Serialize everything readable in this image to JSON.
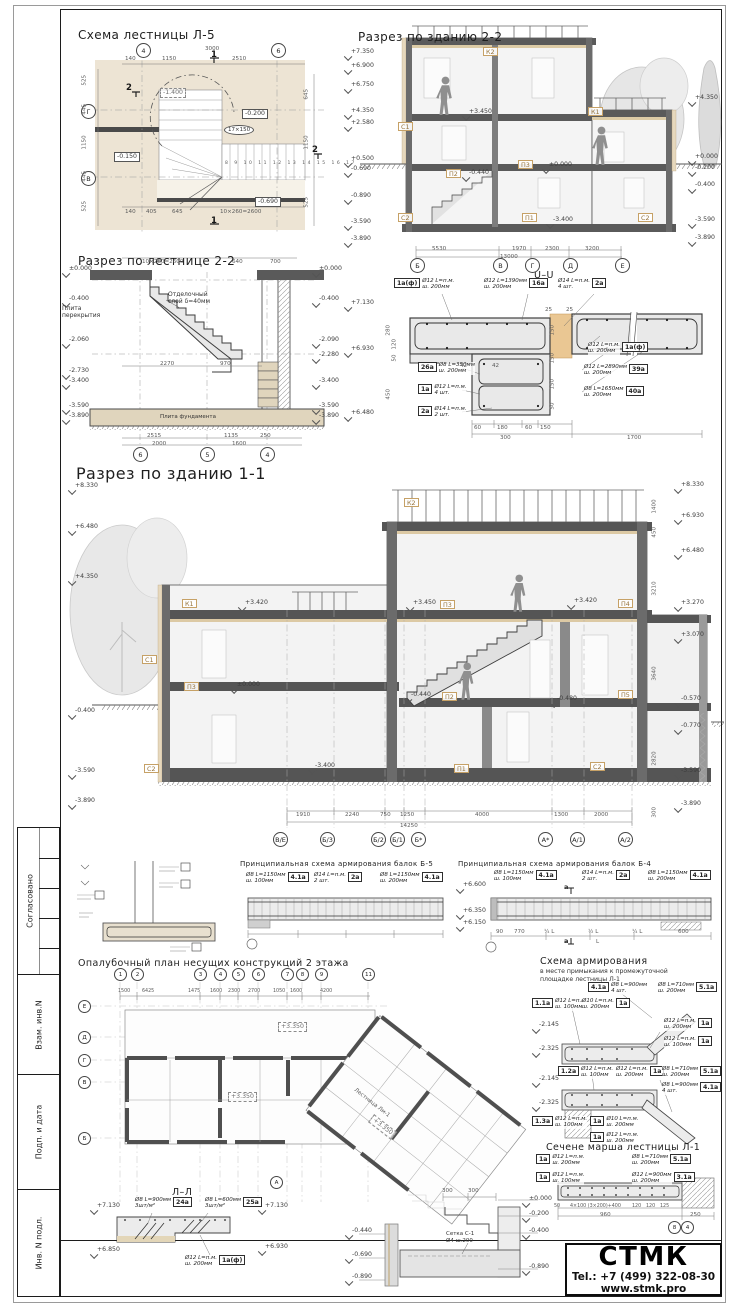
{
  "sidebar": {
    "cells": [
      "Согласовано",
      "Взам. инв.N",
      "Подп. и дата",
      "Инв. N подл."
    ]
  },
  "title_block": {
    "company": "СТМК",
    "phone": "Tel.: +7 (499) 322-08-30",
    "site": "www.stmk.pro"
  },
  "stair_plan": {
    "title": "Схема лестницы Л-5",
    "grid_top": [
      "4",
      "6"
    ],
    "grid_left": [
      "Г",
      "В"
    ],
    "dim_total_top": "3000",
    "dims_top": [
      "140",
      "1150",
      "2510"
    ],
    "dims_bottom": [
      "140",
      "405",
      "645",
      "10×260=2600"
    ],
    "dims_left": [
      "525",
      "445",
      "1150",
      "445",
      "525"
    ],
    "dims_right": [
      "645",
      "1150",
      "525"
    ],
    "elev_dashed": "-1.400",
    "elev_boxes": [
      "-0.200",
      "-0.150",
      "-0.690"
    ],
    "flight_label": "17×150",
    "tread_numbers": "8 9 10 11 12 13 14 15 16 17",
    "cut_marks": [
      "1",
      "1",
      "2",
      "2"
    ]
  },
  "section22": {
    "title": "Разрез по зданию 2-2",
    "elev_left": [
      "+7.350",
      "+6.900",
      "+6.750",
      "+4.350",
      "+2.580",
      "+0.500",
      "-0.690",
      "-0.890",
      "-3.590",
      "-3.890"
    ],
    "elev_right": [
      "+4.350",
      "+0.000",
      "-0.200",
      "-0.400",
      "-3.590",
      "-3.890"
    ],
    "marks": [
      "+3.450",
      "-0.440",
      "±0.000",
      "-3.400"
    ],
    "tags": [
      "К2",
      "К1",
      "С1",
      "П3",
      "П2",
      "С2",
      "П1",
      "С2"
    ],
    "dims_bottom": [
      "5530",
      "1970",
      "2300",
      "3200"
    ],
    "dim_total": "13000",
    "grid_bottom": [
      "Б",
      "В",
      "Г",
      "Д",
      "Е"
    ]
  },
  "stair_section": {
    "title": "Разрез по лестнице 2-2",
    "elev_left": [
      "±0.000",
      "-0.400",
      "-2.060",
      "-2.730",
      "-3.400",
      "-3.590",
      "-3.890"
    ],
    "elev_right": [
      "±0.000",
      "-0.400",
      "-2.090",
      "-2.280",
      "-3.400",
      "-3.590",
      "-3.890"
    ],
    "note_slab": "Плита перекрытия",
    "note_finish_1": "Отделочный",
    "note_finish_2": "слой δ=40мм",
    "note_found": "Плита фундамента",
    "dims_top": [
      "10×260=2600",
      "640",
      "700"
    ],
    "dims_mid": [
      "2270",
      "970"
    ],
    "dims_bottom_1": [
      "2515",
      "1135",
      "250"
    ],
    "dims_bottom_2": [
      "2000",
      "1600"
    ],
    "grid_bottom": [
      "6",
      "5",
      "4"
    ]
  },
  "uu": {
    "title": "U–U",
    "elevs": [
      "+7.130",
      "+6.930",
      "+6.480"
    ],
    "co_box_first": [
      {
        "tag": "1а(ф)",
        "l1": "Ø12 L=п.м.",
        "l2": "ш. 200мм"
      },
      {
        "tag": "26а",
        "l1": "Ø8 L=350мм",
        "l2": "ш. 200мм"
      },
      {
        "tag": "1а",
        "l1": "Ø12 L=п.м.",
        "l2": "4 шт."
      },
      {
        "tag": "2а",
        "l1": "Ø14 L=п.м.",
        "l2": "2 шт."
      }
    ],
    "co_text_first": [
      {
        "tag": "16а",
        "l1": "Ø12 L=1390мм",
        "l2": "ш. 200мм"
      },
      {
        "tag": "2а",
        "l1": "Ø14 L=п.м.",
        "l2": "4 шт."
      },
      {
        "tag": "1а(ф)",
        "l1": "Ø12 L=п.м.",
        "l2": "ш. 200мм"
      },
      {
        "tag": "39а",
        "l1": "Ø12 L=2890мм",
        "l2": "ш. 200мм"
      },
      {
        "tag": "40а",
        "l1": "Ø8 L=1650мм",
        "l2": "ш. 200мм"
      }
    ],
    "dims_h": [
      "60",
      "180",
      "60",
      "150"
    ],
    "dims_row2": [
      "300",
      "1700"
    ],
    "dims_v_left": [
      "280",
      "120",
      "50",
      "450"
    ],
    "dims_v_right": [
      "150",
      "150",
      "150",
      "50"
    ],
    "dims_small": [
      "25",
      "25",
      "42",
      "42"
    ]
  },
  "section11": {
    "title": "Разрез по зданию 1-1",
    "elev_left": [
      "+8.330",
      "+6.480",
      "+4.350",
      "-0.400",
      "-3.590",
      "-3.890"
    ],
    "elev_right": [
      "+8.330",
      "+6.930",
      "+6.480",
      "+3.270",
      "+3.070",
      "-0.570",
      "-0.770",
      "-3.590",
      "-3.890"
    ],
    "marks": [
      "+3.420",
      "+3.450",
      "+3.420",
      "±0.000",
      "-0.440",
      "-0.480",
      "-3.400"
    ],
    "tags": [
      "К2",
      "К1",
      "П3",
      "П4",
      "С1",
      "П3",
      "П2",
      "П5",
      "С2",
      "П1",
      "С2"
    ],
    "dims_bottom": [
      "1910",
      "2240",
      "750",
      "1250",
      "4000",
      "1300",
      "2000"
    ],
    "dim_total": "14250",
    "grid_bottom": [
      "В/Е",
      "Б/3",
      "Б/2",
      "Б/1",
      "Б*",
      "А*",
      "А/1",
      "А/2"
    ],
    "dims_v_right": [
      "1400",
      "450",
      "3210",
      "3640",
      "2820",
      "300"
    ]
  },
  "beam_b5": {
    "title": "Принципиальная схема армирования балок Б-5",
    "callouts": [
      {
        "tag": "4.1а",
        "l1": "Ø8 L=1150мм",
        "l2": "ш. 100мм"
      },
      {
        "tag": "2а",
        "l1": "Ø14 L=п.м.",
        "l2": "2 шт."
      },
      {
        "tag": "4.1а",
        "l1": "Ø8 L=1150мм",
        "l2": "ш. 200мм"
      }
    ]
  },
  "beam_b4": {
    "title": "Принципиальная схема армирования балок Б-4",
    "elevs": [
      "+6.600",
      "+6.350",
      "+6.150"
    ],
    "callouts": [
      {
        "tag": "4.1а",
        "l1": "Ø8 L=1150мм",
        "l2": "ш. 100мм"
      },
      {
        "tag": "2а",
        "l1": "Ø14 L=п.м.",
        "l2": "2 шт."
      },
      {
        "tag": "4.1а",
        "l1": "Ø8 L=1150мм",
        "l2": "ш. 200мм"
      }
    ],
    "dims": [
      "90",
      "770",
      "¼ L",
      "½ L",
      "¼ L",
      "600"
    ],
    "dim_total": "L",
    "cut_label": "а"
  },
  "plan2": {
    "title": "Опалубочный план несущих конструкций 2 этажа",
    "grid_top": [
      "1",
      "2",
      "3",
      "4",
      "5",
      "6",
      "7",
      "8",
      "9",
      "11"
    ],
    "grid_left": [
      "Е",
      "Д",
      "Г",
      "В",
      "Б"
    ],
    "grid_extra": "А",
    "dims_top": [
      "1500",
      "6425",
      "1475",
      "1600",
      "2300",
      "2700",
      "1050",
      "1600",
      "4200"
    ],
    "elev_boxes": [
      "+3.350",
      "+3.350",
      "+3.350"
    ],
    "stair_label": "Лестница Лм-1"
  },
  "reinf": {
    "title": "Схема армирования",
    "subtitle1": "в месте примыкания к промежуточной",
    "subtitle2": "площадке лестницы Л-1",
    "a_elevs": [
      "-2.145",
      "-2.325"
    ],
    "b_elevs": [
      "-2.145",
      "-2.325"
    ],
    "a_box_first": [
      {
        "tag": "1.1а",
        "l1": "Ø12 L=п.м.",
        "l2": "ш. 100мм"
      },
      {
        "tag": "4.1а",
        "l1": "Ø8 L=900мм",
        "l2": "4 шт."
      }
    ],
    "a_text_first": [
      {
        "tag": "1а",
        "l1": "Ø10 L=п.м.",
        "l2": "ш. 200мм"
      },
      {
        "tag": "5.1а",
        "l1": "Ø8 L=710мм",
        "l2": "ш. 200мм"
      },
      {
        "tag": "1а",
        "l1": "Ø12 L=п.м.",
        "l2": "ш. 200мм"
      },
      {
        "tag": "1а",
        "l1": "Ø12 L=п.м.",
        "l2": "ш. 100мм"
      }
    ],
    "b_box_first": [
      {
        "tag": "1.2а",
        "l1": "Ø12 L=п.м.",
        "l2": "ш. 100мм"
      },
      {
        "tag": "1.3а",
        "l1": "Ø12 L=п.м.",
        "l2": "ш. 100мм"
      },
      {
        "tag": "1а",
        "l1": "Ø10 L=п.м.",
        "l2": "ш. 200мм"
      },
      {
        "tag": "1а",
        "l1": "Ø12 L=п.м.",
        "l2": "ш. 200мм"
      }
    ],
    "b_text_first": [
      {
        "tag": "1а",
        "l1": "Ø12 L=п.м.",
        "l2": "ш. 200мм"
      },
      {
        "tag": "5.1а",
        "l1": "Ø8 L=710мм",
        "l2": "ш. 200мм"
      },
      {
        "tag": "4.1а",
        "l1": "Ø8 L=900мм",
        "l2": "4 шт."
      }
    ]
  },
  "flight": {
    "title": "Сечене марша лестницы Л-1",
    "box_first": [
      {
        "tag": "1а",
        "l1": "Ø12 L=п.м.",
        "l2": "ш. 200мм"
      },
      {
        "tag": "1а",
        "l1": "Ø12 L=п.м.",
        "l2": "ш. 100мм"
      }
    ],
    "text_first": [
      {
        "tag": "5.1а",
        "l1": "Ø8 L=710мм",
        "l2": "ш. 200мм"
      },
      {
        "tag": "3.1а",
        "l1": "Ø12 L=900мм",
        "l2": "ш. 200мм"
      }
    ],
    "dims_1": [
      "50",
      "4×100 (3×200)+400",
      "120",
      "120",
      "125"
    ],
    "dims_2": [
      "960",
      "250"
    ],
    "grid": [
      "8",
      "4"
    ]
  },
  "ll": {
    "title": "Л–Л",
    "elev_left": [
      "+7.130",
      "+6.850"
    ],
    "elev_right": [
      "+7.130",
      "+6.930"
    ],
    "callouts": [
      {
        "tag": "24а",
        "l1": "Ø8 L=900мм",
        "l2": "3шт/м²"
      },
      {
        "tag": "25а",
        "l1": "Ø8 L=600мм",
        "l2": "3шт/м²"
      },
      {
        "tag": "1а(ф)",
        "l1": "Ø12 L=п.м.",
        "l2": "ш. 200мм"
      }
    ]
  },
  "step": {
    "elevs": [
      "±0.000",
      "-0.200",
      "-0.400",
      "-0.890"
    ],
    "mesh1": "Сетка С-1",
    "mesh2": "Ø4 ш.200",
    "dims": [
      "300",
      "300"
    ]
  },
  "wallmini": {
    "elevs": [
      "-0.440",
      "-0.690",
      "-0.890"
    ]
  }
}
